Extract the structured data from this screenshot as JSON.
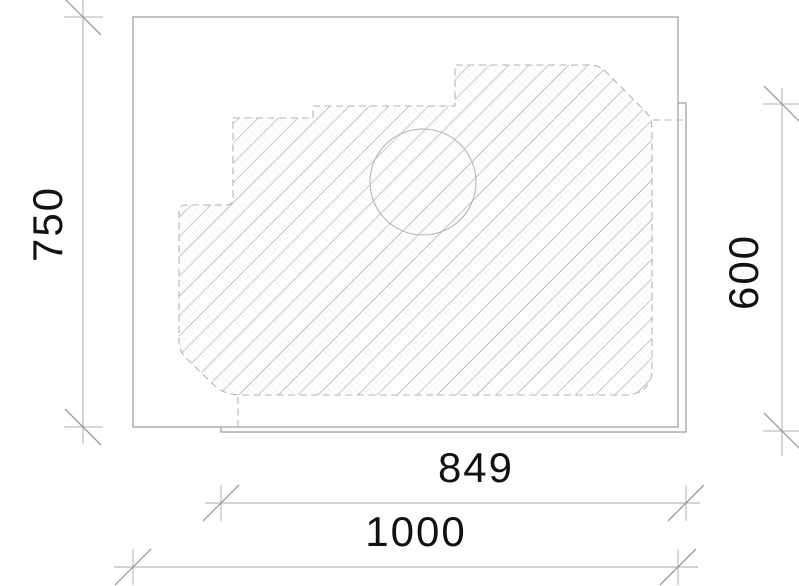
{
  "drawing": {
    "type": "cad-plan-technical-drawing",
    "dims": {
      "left": "750",
      "right": "600",
      "inner_width": "849",
      "outer_width": "1000"
    },
    "shapes": {
      "outer_slab": "rectangle 1000 x 750",
      "inner_slab": "rectangle 849 x 600 (partially hidden)",
      "hatched_object": "irregular hatched slab with dashed outline",
      "cutout": "circle"
    },
    "colors": {
      "background": "#ffffff",
      "solid_line": "#9a9a9a",
      "dashed_line": "#b3b3b3",
      "dimension_line": "#a8a8a8",
      "hatch_dark": "#8f8f8f",
      "hatch_light": "#c9c9c9",
      "hatch_fabric": "#ebebeb",
      "text": "#111111"
    }
  }
}
